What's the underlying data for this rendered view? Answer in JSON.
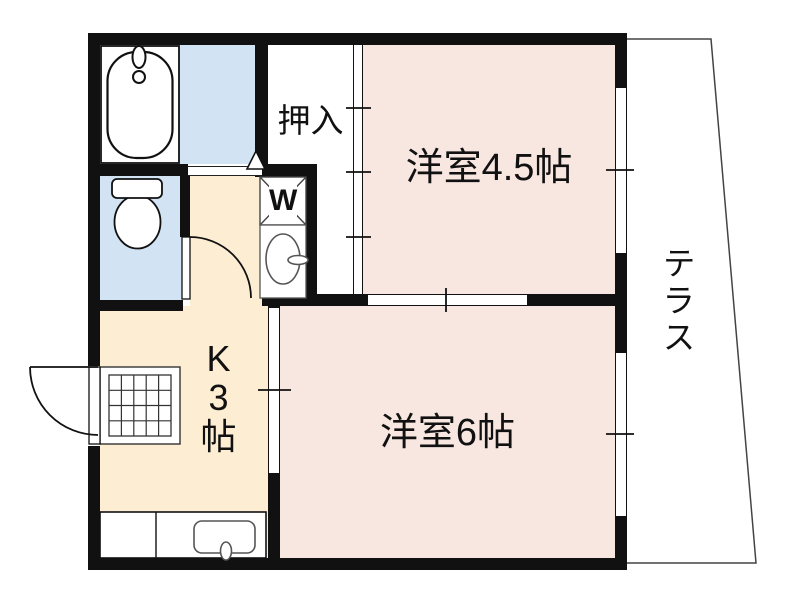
{
  "floorplan": {
    "title": "apartment-floor-plan",
    "rooms": {
      "western_room_45": {
        "label": "洋室4.5帖"
      },
      "western_room_6": {
        "label": "洋室6帖"
      },
      "kitchen": {
        "lines": [
          "K",
          "3",
          "帖"
        ]
      },
      "closet": {
        "label": "押入"
      },
      "terrace": {
        "label": "テラス"
      },
      "washing_machine": {
        "label": "W"
      }
    },
    "colors": {
      "room_pink": "#f8e6e1",
      "kitchen_beige": "#fdeed3",
      "wet_area_blue": "#d2e4f3",
      "wall_black": "#111111",
      "fixture_gray": "#555555"
    }
  }
}
